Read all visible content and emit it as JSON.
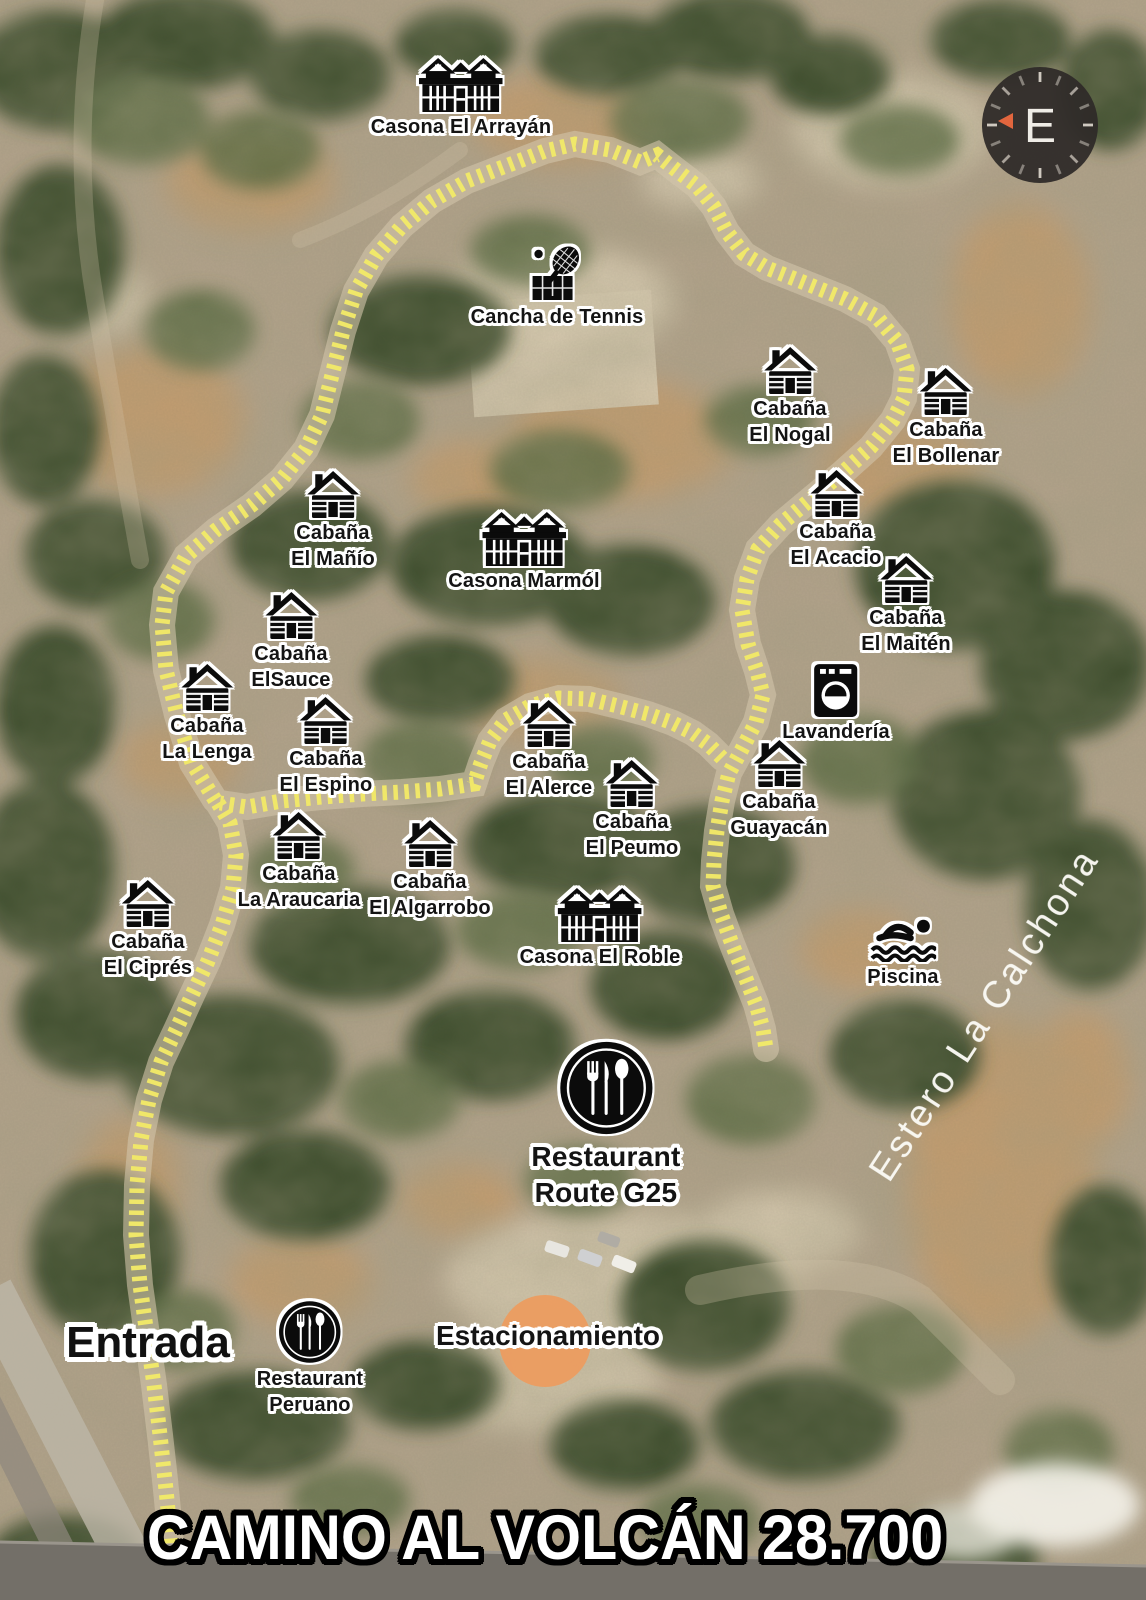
{
  "map": {
    "banner": "CAMINO AL VOLCÁN 28.700",
    "entrada_label": "Entrada",
    "estacionamiento_label": "Estacionamiento",
    "estero_label": "Estero La Calchona",
    "compass_letter": "E",
    "colors": {
      "trail_yellow": "#f2e968",
      "label_outline": "#ffffff",
      "icon_black": "#0b0b0b",
      "parking_circle": "#ec9c60",
      "compass_arrow": "#e2663e"
    },
    "markers": [
      {
        "id": "casona-el-arrayan",
        "icon": "casona",
        "lines": [
          "Casona El Arrayán"
        ],
        "x": 461,
        "y": 58
      },
      {
        "id": "cancha-de-tennis",
        "icon": "tennis",
        "lines": [
          "Cancha de Tennis"
        ],
        "x": 557,
        "y": 246
      },
      {
        "id": "cabana-el-nogal",
        "icon": "cabin",
        "lines": [
          "Cabaña",
          "El Nogal"
        ],
        "x": 790,
        "y": 347
      },
      {
        "id": "cabana-el-bollenar",
        "icon": "cabin",
        "lines": [
          "Cabaña",
          "El Bollenar"
        ],
        "x": 946,
        "y": 368
      },
      {
        "id": "cabana-el-manio",
        "icon": "cabin",
        "lines": [
          "Cabaña",
          "El Mañío"
        ],
        "x": 333,
        "y": 471
      },
      {
        "id": "cabana-el-acacio",
        "icon": "cabin",
        "lines": [
          "Cabaña",
          "El Acacio"
        ],
        "x": 836,
        "y": 470
      },
      {
        "id": "casona-marmol",
        "icon": "casona",
        "lines": [
          "Casona Marmól"
        ],
        "x": 524,
        "y": 512
      },
      {
        "id": "cabana-el-maiten",
        "icon": "cabin",
        "lines": [
          "Cabaña",
          "El Maitén"
        ],
        "x": 906,
        "y": 556
      },
      {
        "id": "cabana-elsauce",
        "icon": "cabin",
        "lines": [
          "Cabaña",
          "ElSauce"
        ],
        "x": 291,
        "y": 592
      },
      {
        "id": "cabana-la-lenga",
        "icon": "cabin",
        "lines": [
          "Cabaña",
          "La Lenga"
        ],
        "x": 207,
        "y": 664
      },
      {
        "id": "lavanderia",
        "icon": "laundry",
        "lines": [
          "Lavandería"
        ],
        "x": 836,
        "y": 664
      },
      {
        "id": "cabana-el-espino",
        "icon": "cabin",
        "lines": [
          "Cabaña",
          "El Espino"
        ],
        "x": 326,
        "y": 697
      },
      {
        "id": "cabana-el-alerce",
        "icon": "cabin",
        "lines": [
          "Cabaña",
          "El Alerce"
        ],
        "x": 549,
        "y": 700
      },
      {
        "id": "cabana-guayacan",
        "icon": "cabin",
        "lines": [
          "Cabaña",
          "Guayacán"
        ],
        "x": 779,
        "y": 740
      },
      {
        "id": "cabana-el-peumo",
        "icon": "cabin",
        "lines": [
          "Cabaña",
          "El Peumo"
        ],
        "x": 632,
        "y": 760
      },
      {
        "id": "cabana-la-araucaria",
        "icon": "cabin",
        "lines": [
          "Cabaña",
          "La Araucaria"
        ],
        "x": 299,
        "y": 812
      },
      {
        "id": "cabana-el-algarrobo",
        "icon": "cabin",
        "lines": [
          "Cabaña",
          "El Algarrobo"
        ],
        "x": 430,
        "y": 820
      },
      {
        "id": "cabana-el-cipres",
        "icon": "cabin",
        "lines": [
          "Cabaña",
          "El Ciprés"
        ],
        "x": 148,
        "y": 880
      },
      {
        "id": "casona-el-roble",
        "icon": "casona",
        "lines": [
          "Casona El Roble"
        ],
        "x": 600,
        "y": 888
      },
      {
        "id": "piscina",
        "icon": "pool",
        "lines": [
          "Piscina"
        ],
        "x": 903,
        "y": 916
      },
      {
        "id": "restaurant-route-g25",
        "icon": "restaurant",
        "variant": "large",
        "lines": [
          "Restaurant",
          "Route G25"
        ],
        "x": 606,
        "y": 1040
      },
      {
        "id": "restaurant-peruano",
        "icon": "restaurant",
        "variant": "small",
        "lines": [
          "Restaurant",
          "Peruano"
        ],
        "x": 310,
        "y": 1300
      }
    ]
  }
}
